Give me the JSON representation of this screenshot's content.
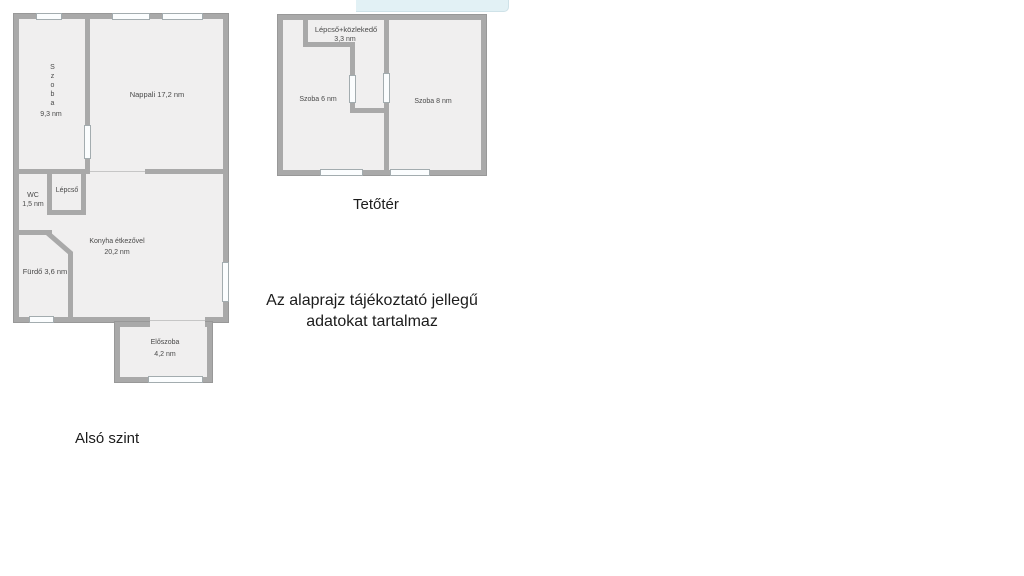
{
  "colors": {
    "wall": "#a9a9a9",
    "wall_edge": "#989898",
    "room_fill": "#f0efef",
    "window_fill": "#fbfdfe",
    "highlight_bar": "#e2f1f5",
    "caption_text": "#1c1c1c",
    "room_label_text": "#4a4a4a"
  },
  "lower_plan": {
    "caption": "Alsó szint",
    "rooms": {
      "szoba": {
        "name": "Szoba",
        "area": "9,3 nm"
      },
      "nappali": {
        "label": "Nappali 17,2 nm"
      },
      "wc": {
        "name": "WC",
        "area": "1,5 nm"
      },
      "lepcso": {
        "name": "Lépcső"
      },
      "konyha": {
        "name": "Konyha étkezővel",
        "area": "20,2 nm"
      },
      "furdo": {
        "label": "Fürdő 3,6 nm"
      },
      "eloszoba": {
        "name": "Előszoba",
        "area": "4,2 nm"
      }
    }
  },
  "upper_plan": {
    "caption": "Tetőtér",
    "rooms": {
      "lepcso_kozlekedo": {
        "name": "Lépcső+közlekedő",
        "area": "3,3 nm"
      },
      "szoba_6": {
        "label": "Szoba 6 nm"
      },
      "szoba_8": {
        "label": "Szoba 8 nm"
      }
    }
  },
  "disclaimer": {
    "text": "Az alaprajz tájékoztató jellegű\nadatokat tartalmaz"
  }
}
